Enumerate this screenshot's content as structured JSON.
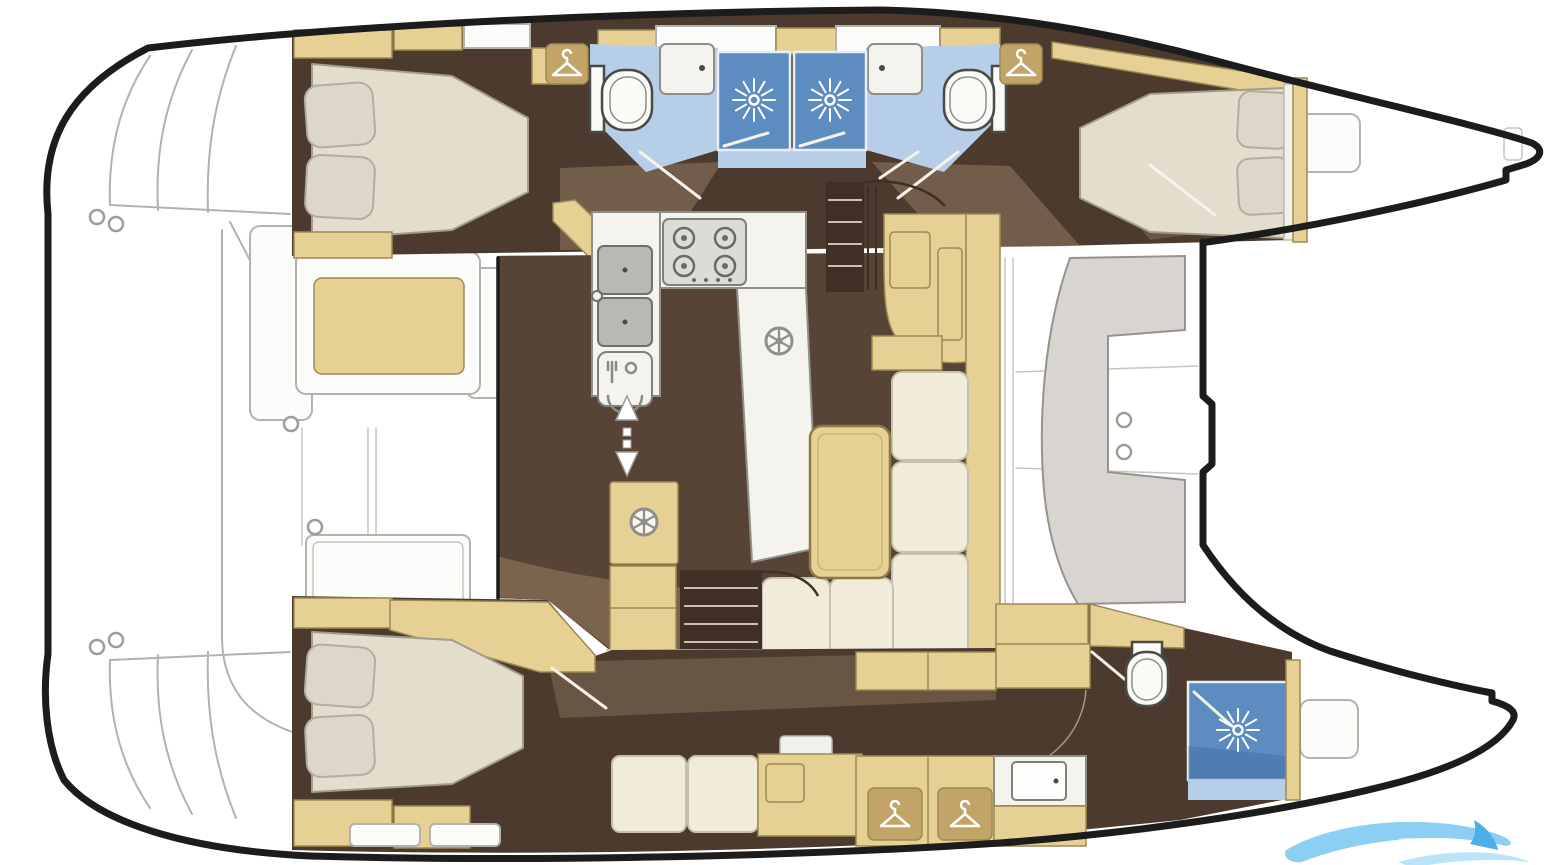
{
  "diagram": {
    "type": "yacht-floor-plan",
    "vessel": "sailing catamaran",
    "view": "top-down interior layout, bow pointing right",
    "visible_text": "",
    "watermark": {
      "icon": "wave-watermark-icon",
      "position": "bottom-right"
    },
    "hulls": [
      {
        "id": "port-hull",
        "position": "top",
        "rooms": [
          {
            "name": "aft-double-cabin",
            "features": [
              "double-berth",
              "pillows",
              "wardrobe-cabinets"
            ]
          },
          {
            "name": "aft-bathroom",
            "features": [
              "toilet",
              "washbasin",
              "shower-stall",
              "hanging-locker"
            ]
          },
          {
            "name": "forward-bathroom",
            "features": [
              "toilet",
              "washbasin",
              "shower-stall",
              "hanging-locker"
            ]
          },
          {
            "name": "forward-double-cabin",
            "features": [
              "double-berth",
              "pillows",
              "shelf"
            ]
          }
        ]
      },
      {
        "id": "starboard-hull",
        "position": "bottom",
        "rooms": [
          {
            "name": "aft-double-cabin",
            "features": [
              "double-berth",
              "pillows",
              "seat-cushions"
            ]
          },
          {
            "name": "dressing-area",
            "features": [
              "settee",
              "vanity-desk",
              "two-hanging-wardrobes"
            ]
          },
          {
            "name": "forward-bathroom",
            "features": [
              "toilet",
              "shower-stall",
              "washbasin"
            ]
          }
        ]
      }
    ],
    "bridgedeck": {
      "rooms": [
        {
          "name": "aft-cockpit",
          "features": [
            "bench-seat",
            "side-bench",
            "cockpit-table",
            "wet-bar",
            "deck-grate",
            "transom-steps"
          ]
        },
        {
          "name": "salon",
          "features": [
            "u-shaped-galley",
            "double-sink",
            "four-burner-stove",
            "dishwasher",
            "l-shaped-sofa",
            "salon-table",
            "nav-cabinet",
            "stairs-to-port-hull",
            "stairs-to-starboard-hull",
            "sliding-door"
          ]
        },
        {
          "name": "foredeck",
          "features": [
            "c-shaped-lounge-seat",
            "deck-hatches",
            "cup-holders"
          ]
        }
      ]
    },
    "icons": [
      {
        "name": "hanger-icon",
        "count": 4
      },
      {
        "name": "shower-rose-icon",
        "count": 3
      },
      {
        "name": "toilet-icon",
        "count": 3
      },
      {
        "name": "sink-icon",
        "count": 4
      },
      {
        "name": "stove-burner-icon",
        "count": 4
      },
      {
        "name": "cutlery-dishwasher-icon",
        "count": 1
      },
      {
        "name": "vent-wheel-icon",
        "count": 2
      },
      {
        "name": "sliding-door-arrows-icon",
        "count": 1
      },
      {
        "name": "companionway-arrows-icon",
        "count": 1
      },
      {
        "name": "deck-ring-icon",
        "count": 3
      },
      {
        "name": "wave-watermark-icon",
        "count": 1
      }
    ]
  },
  "colors": {
    "hull": "#1c1c1c",
    "sketch": "#b3b3ad",
    "deck": "#fcfcfa",
    "floorDark": "#4c3a2e",
    "floorMid": "#584436",
    "overlay": "#a08a6d",
    "lightSwath": "#8a7259",
    "tan": "#e7d094",
    "tanB": "#9c8a55",
    "tanD": "#c2a368",
    "mattress": "#e4ddcd",
    "matB": "#a29c8f",
    "pillow": "#ddd7ca",
    "pilB": "#b3ad9f",
    "cream": "#f1ebdc",
    "creamB": "#c7c0ae",
    "counter": "#f4f3ee",
    "cntB": "#8f8f88",
    "bathBlue": "#b7cee8",
    "showerBlue": "#5d8cc0",
    "showerDeep": "#2f5e93",
    "porcelain": "#fafaf7",
    "porB": "#4a4a46",
    "steel": "#b9b9b3",
    "steelB": "#70706a",
    "tread": "#3f2f26",
    "treadLine": "#cdbfa8",
    "grate": "#8b8b7d",
    "grateB": "#6d6d60",
    "grateDot": "#4f4f44",
    "arrowCream": "#e8dcc2",
    "waveMain": "#82cdf2",
    "waveLight": "#b5e3f8",
    "waveFin": "#3fa9e4"
  }
}
